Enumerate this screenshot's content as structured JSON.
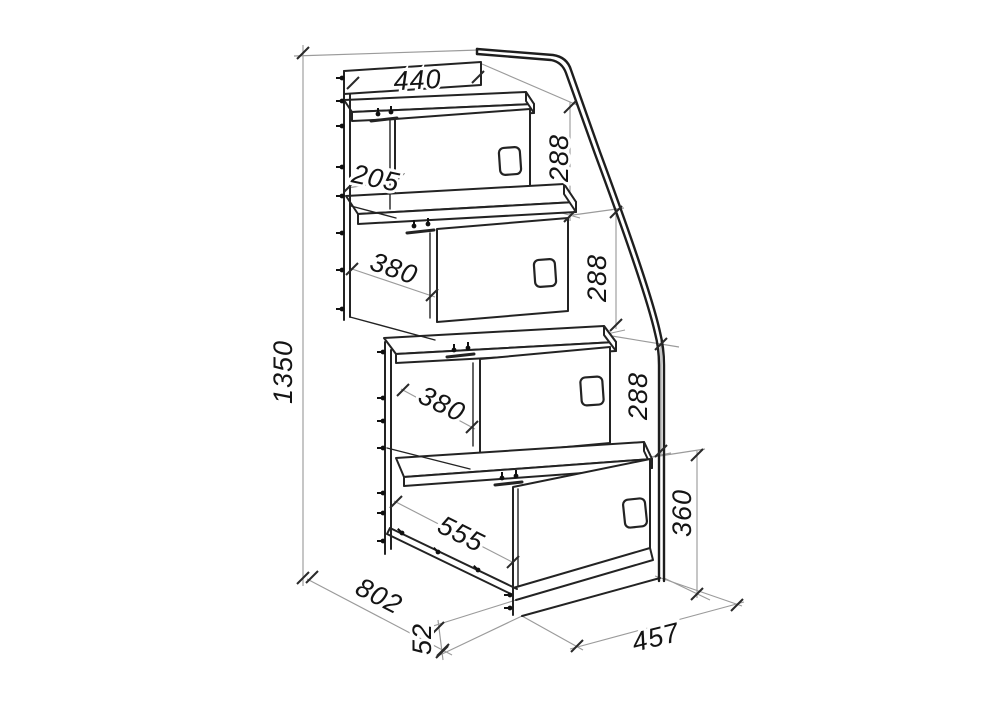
{
  "drawing": {
    "subject": "staircase-chest-technical-drawing",
    "units": "mm",
    "dimensions": {
      "top_width": "440",
      "top_depth": "205",
      "step1_height": "288",
      "step2_height": "288",
      "step3_height": "288",
      "step2_depth": "380",
      "step3_depth": "380",
      "bottom_depth": "555",
      "bottom_height": "360",
      "bottom_width": "457",
      "total_height": "1350",
      "total_depth": "802",
      "base_height": "52"
    },
    "colors": {
      "outline_dark": "#232323",
      "construction_light": "#9b9b9b",
      "background": "#ffffff"
    }
  }
}
